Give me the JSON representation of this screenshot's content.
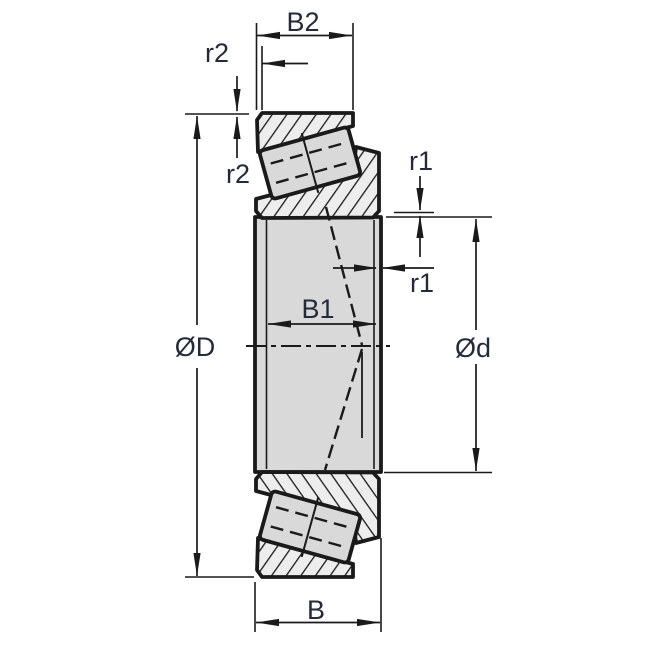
{
  "diagram": {
    "type": "tapered-roller-bearing-cross-section",
    "labels": {
      "width_outer_ring": "B2",
      "chamfer_outer_horizontal": "r2",
      "chamfer_outer_vertical": "r2",
      "chamfer_inner_vertical": "r1",
      "chamfer_inner_horizontal": "r1",
      "width_inner": "B1",
      "outer_diameter": "ØD",
      "bore_diameter": "Ød",
      "width_total": "B"
    },
    "colors": {
      "line": "#1a1a1a",
      "label_text": "#242a3a",
      "solid_fill": "#d9d9d9",
      "hatch_background": "#ededed",
      "background": "#ffffff"
    }
  }
}
